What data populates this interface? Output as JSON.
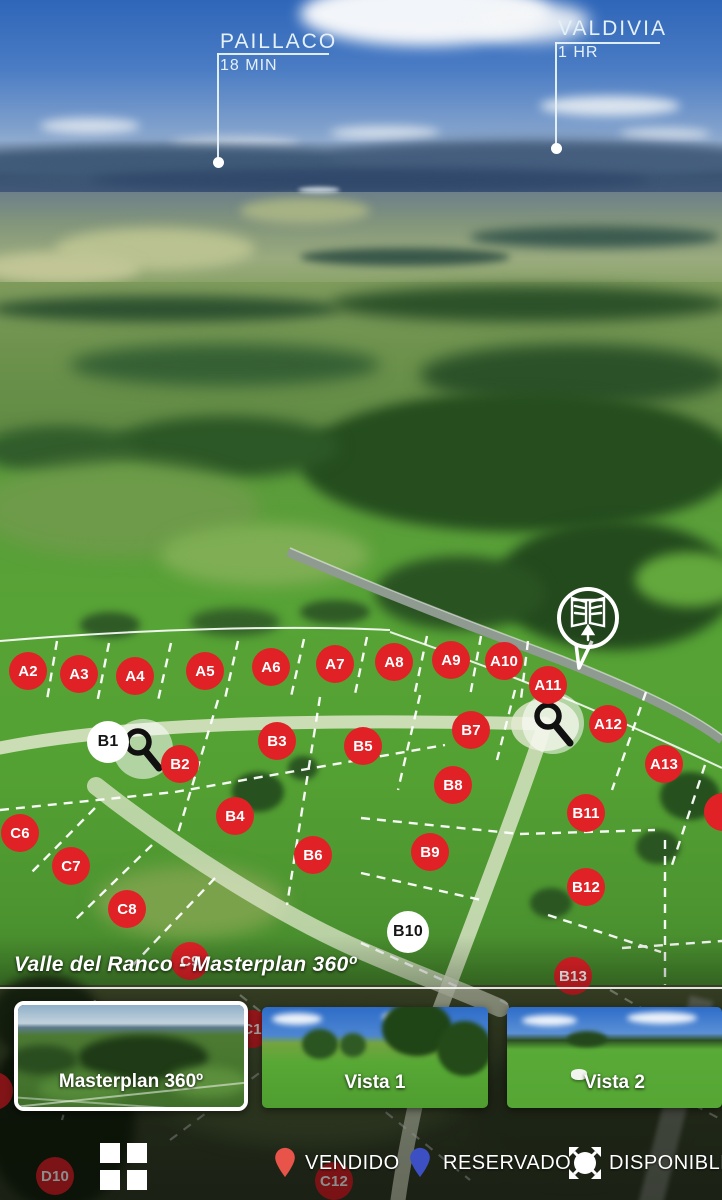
{
  "top_labels": {
    "paillaco": {
      "city": "PAILLACO",
      "time": "18 MIN"
    },
    "valdivia": {
      "city": "VALDIVIA",
      "time": "1 HR"
    }
  },
  "title": "Valle del Ranco - Masterplan 360º",
  "markers": [
    {
      "label": "A2",
      "x": 28,
      "y": 671,
      "status": "sold"
    },
    {
      "label": "A3",
      "x": 79,
      "y": 674,
      "status": "sold"
    },
    {
      "label": "A4",
      "x": 135,
      "y": 676,
      "status": "sold"
    },
    {
      "label": "A5",
      "x": 205,
      "y": 671,
      "status": "sold"
    },
    {
      "label": "A6",
      "x": 271,
      "y": 667,
      "status": "sold"
    },
    {
      "label": "A7",
      "x": 335,
      "y": 664,
      "status": "sold"
    },
    {
      "label": "A8",
      "x": 394,
      "y": 662,
      "status": "sold"
    },
    {
      "label": "A9",
      "x": 451,
      "y": 660,
      "status": "sold"
    },
    {
      "label": "A10",
      "x": 504,
      "y": 661,
      "status": "sold"
    },
    {
      "label": "A11",
      "x": 548,
      "y": 685,
      "status": "sold"
    },
    {
      "label": "A12",
      "x": 608,
      "y": 724,
      "status": "sold"
    },
    {
      "label": "A13",
      "x": 664,
      "y": 764,
      "status": "sold"
    },
    {
      "label": "",
      "x": 723,
      "y": 812,
      "status": "sold"
    },
    {
      "label": "B1",
      "x": 108,
      "y": 742,
      "status": "available"
    },
    {
      "label": "B2",
      "x": 180,
      "y": 764,
      "status": "sold"
    },
    {
      "label": "B3",
      "x": 277,
      "y": 741,
      "status": "sold"
    },
    {
      "label": "B4",
      "x": 235,
      "y": 816,
      "status": "sold"
    },
    {
      "label": "B5",
      "x": 363,
      "y": 746,
      "status": "sold"
    },
    {
      "label": "B6",
      "x": 313,
      "y": 855,
      "status": "sold"
    },
    {
      "label": "B7",
      "x": 471,
      "y": 730,
      "status": "sold"
    },
    {
      "label": "B8",
      "x": 453,
      "y": 785,
      "status": "sold"
    },
    {
      "label": "B9",
      "x": 430,
      "y": 852,
      "status": "sold"
    },
    {
      "label": "B10",
      "x": 408,
      "y": 932,
      "status": "available"
    },
    {
      "label": "B11",
      "x": 586,
      "y": 813,
      "status": "sold"
    },
    {
      "label": "B12",
      "x": 586,
      "y": 887,
      "status": "sold"
    },
    {
      "label": "B13",
      "x": 573,
      "y": 976,
      "status": "sold",
      "dim": true
    },
    {
      "label": "C6",
      "x": 20,
      "y": 833,
      "status": "sold"
    },
    {
      "label": "C7",
      "x": 71,
      "y": 866,
      "status": "sold"
    },
    {
      "label": "C8",
      "x": 127,
      "y": 909,
      "status": "sold"
    },
    {
      "label": "C9",
      "x": 190,
      "y": 961,
      "status": "sold",
      "dim": true
    },
    {
      "label": "C1",
      "x": 252,
      "y": 1029,
      "status": "sold",
      "dim": true
    },
    {
      "label": "9",
      "x": -6,
      "y": 1091,
      "status": "sold",
      "dim": true
    },
    {
      "label": "C12",
      "x": 334,
      "y": 1181,
      "status": "sold",
      "dim": true
    },
    {
      "label": "D10",
      "x": 55,
      "y": 1176,
      "status": "sold",
      "dim": true
    }
  ],
  "zoom_indicators": [
    {
      "x": 142,
      "y": 748
    },
    {
      "x": 553,
      "y": 722
    }
  ],
  "entrance_pin": {
    "x": 588,
    "y": 618
  },
  "thumbnails": [
    {
      "label": "Masterplan 360º",
      "selected": true
    },
    {
      "label": "Vista 1",
      "selected": false
    },
    {
      "label": "Vista 2",
      "selected": false
    }
  ],
  "legend": [
    {
      "label": "VENDIDO",
      "icon": "pin",
      "color": "#e8544a"
    },
    {
      "label": "RESERVADO",
      "icon": "pin",
      "color": "#3c50c4"
    },
    {
      "label": "DISPONIBLE",
      "icon": "pano-arrows",
      "color": "#ffffff"
    }
  ],
  "colors": {
    "marker_sold": "#e02227",
    "marker_available": "#ffffff",
    "accent_white": "#ffffff"
  }
}
